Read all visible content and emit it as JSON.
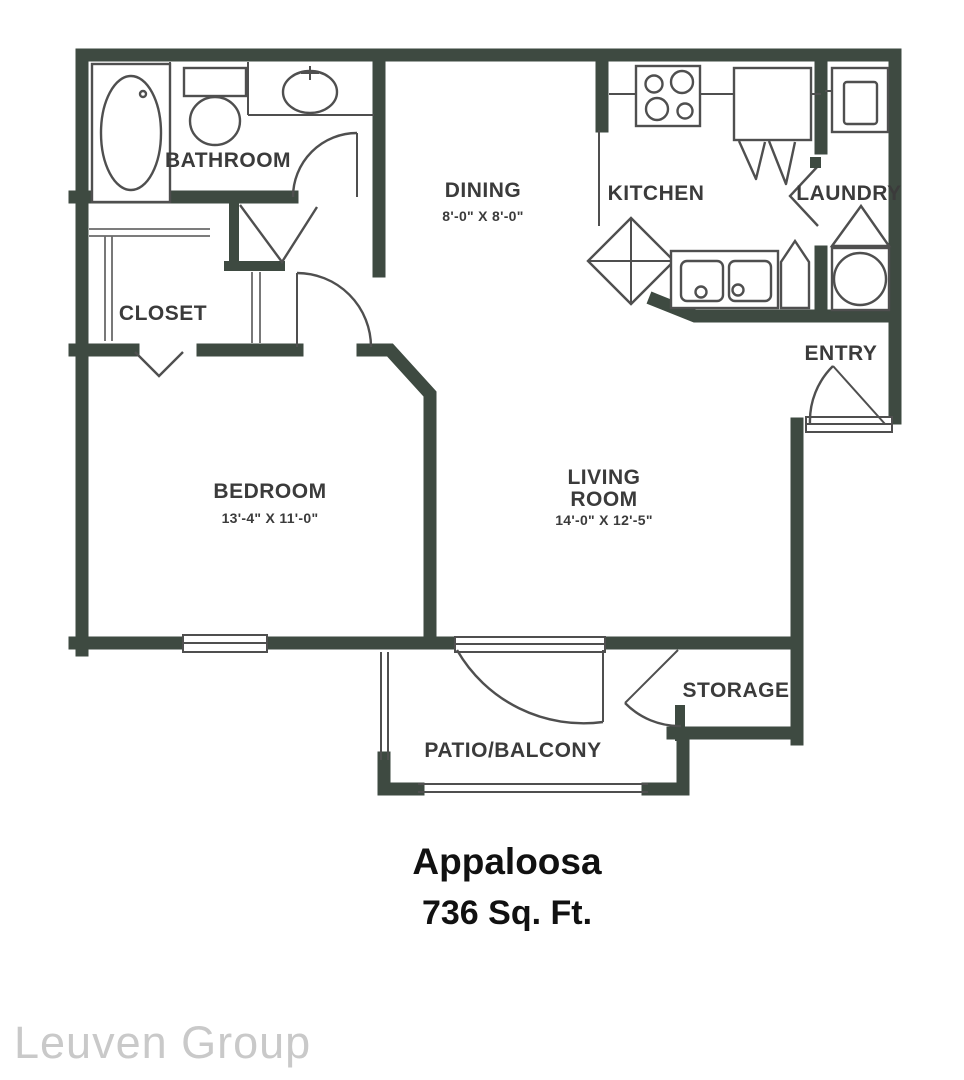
{
  "floorplan": {
    "name": "Appaloosa",
    "area": "736 Sq. Ft.",
    "watermark": "Leuven Group",
    "labels": {
      "bathroom": "BATHROOM",
      "closet": "CLOSET",
      "dining": "DINING",
      "dining_dims": "8'-0\" X 8'-0\"",
      "kitchen": "KITCHEN",
      "laundry": "LAUNDRY",
      "entry": "ENTRY",
      "bedroom": "BEDROOM",
      "bedroom_dims": "13'-4\" X 11'-0\"",
      "living_1": "LIVING",
      "living_2": "ROOM",
      "living_dims": "14'-0\" X 12'-5\"",
      "storage": "STORAGE",
      "patio": "PATIO/BALCONY"
    },
    "fixtures": [
      "bathtub",
      "toilet",
      "bathroom-sink",
      "stove",
      "refrigerator",
      "kitchen-island",
      "double-sink",
      "corner-cabinet",
      "washer",
      "dryer"
    ],
    "colors": {
      "wall": "#3e4a41",
      "fixture_line": "#4f4f4f",
      "label_text": "#3b3b3b",
      "title_text": "#111111",
      "watermark_text": "#c9c9c9"
    }
  }
}
